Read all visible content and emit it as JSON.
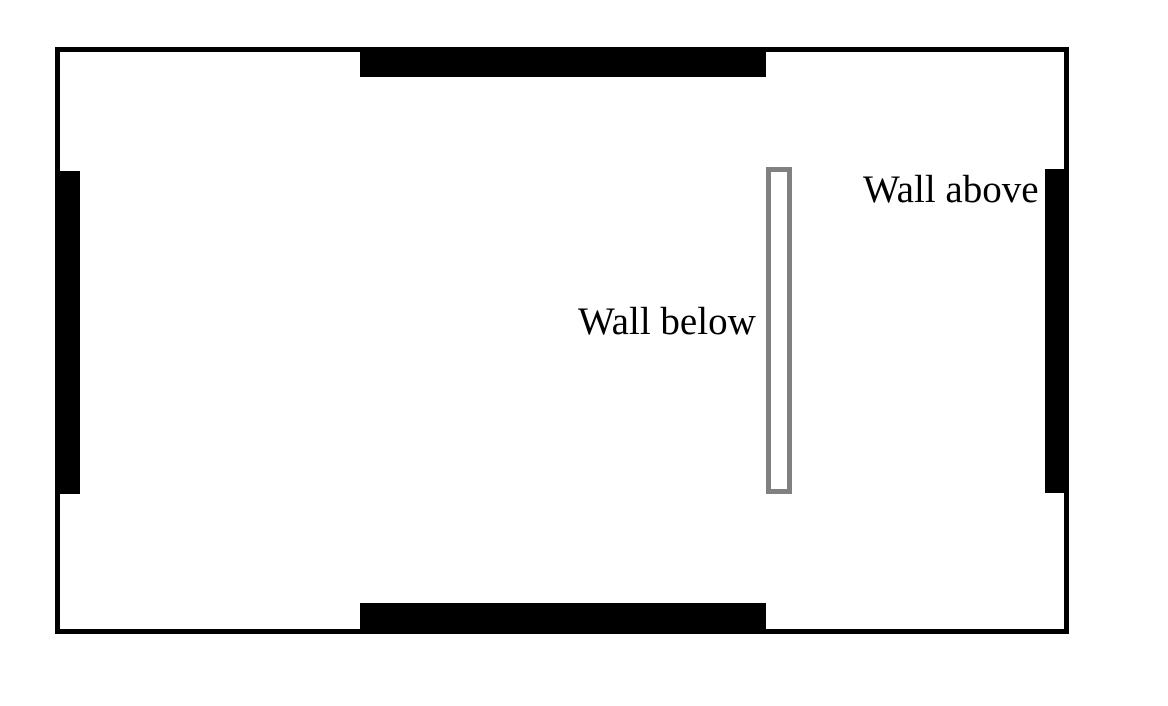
{
  "diagram": {
    "background_color": "#ffffff",
    "wall_color": "#000000",
    "open_wall_color": "#808080",
    "room_outline": {
      "x": 55,
      "y": 47,
      "w": 1014,
      "h": 587,
      "fill": "#ffffff",
      "stroke": "#000000",
      "stroke_width": 5
    },
    "solid_walls": [
      {
        "name": "top-wall",
        "x": 360,
        "y": 47,
        "w": 406,
        "h": 30,
        "fill": "#000000"
      },
      {
        "name": "bottom-wall",
        "x": 360,
        "y": 603,
        "w": 406,
        "h": 31,
        "fill": "#000000"
      },
      {
        "name": "left-wall",
        "x": 55,
        "y": 171,
        "w": 25,
        "h": 323,
        "fill": "#000000"
      },
      {
        "name": "right-wall",
        "x": 1045,
        "y": 169,
        "w": 24,
        "h": 324,
        "fill": "#000000"
      }
    ],
    "open_wall": {
      "x": 766,
      "y": 167,
      "w": 26,
      "h": 327,
      "fill": "#ffffff",
      "stroke": "#808080",
      "stroke_width": 5
    },
    "labels": [
      {
        "text": "Wall above",
        "x": 863,
        "y": 170
      },
      {
        "text": "Wall below",
        "x": 578,
        "y": 302
      }
    ]
  }
}
